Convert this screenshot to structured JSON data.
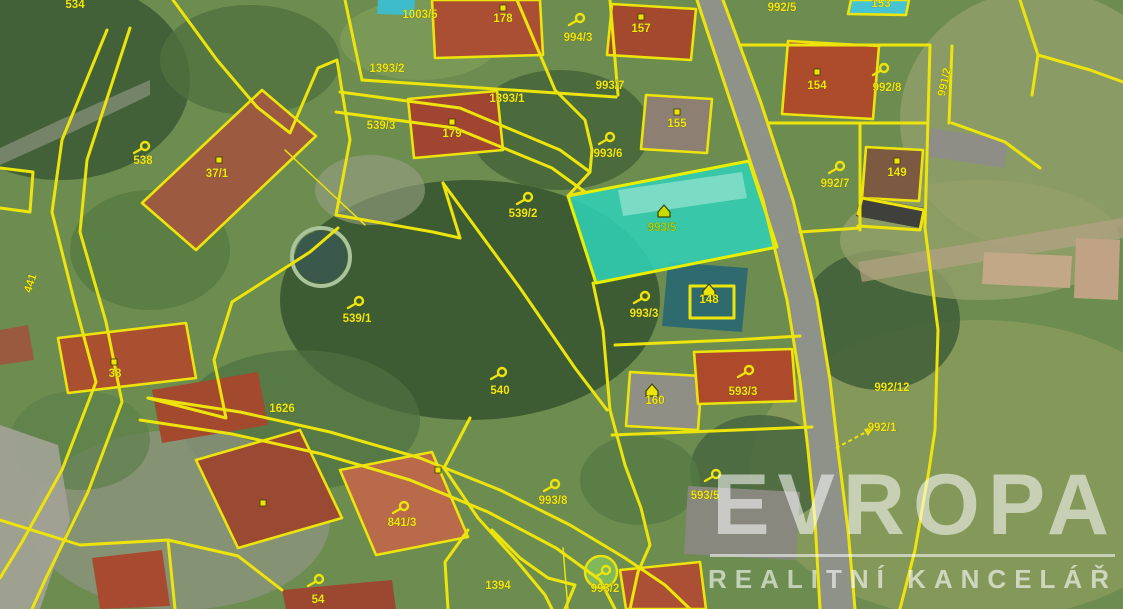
{
  "watermark": {
    "title": "EVROPA",
    "subtitle": "REALITNÍ KANCELÁŘ"
  },
  "map": {
    "colors": {
      "line": "#ede40b",
      "label": "#f0e714",
      "highlight_fill": "#2fd2b8",
      "highlight_label": "#9fd41c",
      "road_fill": "#8e9289"
    },
    "vegetation": [
      [
        60,
        80,
        130,
        100,
        "#3e5c36",
        0.9
      ],
      [
        250,
        60,
        90,
        55,
        "#50713f",
        0.8
      ],
      [
        470,
        300,
        190,
        120,
        "#3c5a32",
        0.95
      ],
      [
        560,
        130,
        90,
        60,
        "#47653a",
        0.85
      ],
      [
        150,
        250,
        80,
        60,
        "#567a42",
        0.8
      ],
      [
        300,
        420,
        120,
        70,
        "#4e7040",
        0.7
      ],
      [
        980,
        470,
        230,
        150,
        "#84985a",
        1
      ],
      [
        1040,
        120,
        140,
        130,
        "#8d9c68",
        0.9
      ],
      [
        880,
        320,
        80,
        70,
        "#43613a",
        0.9
      ],
      [
        760,
        470,
        70,
        55,
        "#48663e",
        0.85
      ],
      [
        180,
        520,
        150,
        90,
        "#8f9480",
        0.75
      ],
      [
        420,
        40,
        80,
        40,
        "#7d9b58",
        0.8
      ],
      [
        640,
        480,
        60,
        45,
        "#557a44",
        0.8
      ],
      [
        80,
        440,
        70,
        50,
        "#5d7f4a",
        0.7
      ],
      [
        980,
        240,
        140,
        60,
        "#93a06a",
        0.8
      ],
      [
        370,
        190,
        55,
        35,
        "#9aa086",
        0.6
      ]
    ],
    "surfaces": [
      {
        "name": "main-road",
        "pts": "697,0 730,100 763,200 787,300 800,380 808,450 815,520 820,609 855,609 848,530 838,450 830,380 817,300 793,200 760,100 723,0",
        "fill": "#8e9289",
        "op": 1
      },
      {
        "name": "left-street",
        "pts": "0,425 58,445 70,520 40,609 0,609",
        "fill": "#a3a396",
        "op": 0.9
      },
      {
        "name": "dirt-track",
        "pts": "858,262 1123,218 1123,238 862,282",
        "fill": "#b3a383",
        "op": 0.7
      },
      {
        "name": "path-top-left",
        "pts": "0,148 60,120 150,80 150,95 60,138 0,165",
        "fill": "#a8a89a",
        "op": 0.5
      }
    ],
    "buildings": [
      {
        "pts": "142,203 262,90 316,136 196,250",
        "fill": "#9c5a40",
        "outline": true
      },
      {
        "pts": "432,0 540,0 543,55 435,58",
        "fill": "#aa4f33",
        "outline": true
      },
      {
        "pts": "612,4 696,9 691,60 607,55",
        "fill": "#a34a2e",
        "outline": true
      },
      {
        "pts": "408,99 497,91 503,150 414,158",
        "fill": "#a04531",
        "outline": true
      },
      {
        "pts": "646,95 712,99 707,153 641,149",
        "fill": "#8d7f72",
        "outline": true
      },
      {
        "pts": "788,41 879,46 873,119 782,114",
        "fill": "#ad4c2a",
        "outline": true
      },
      {
        "pts": "866,147 923,150 919,201 862,198",
        "fill": "#7c5a42",
        "outline": true
      },
      {
        "pts": "851,0 909,0 906,15 848,14",
        "fill": "#45c4d4",
        "outline": true
      },
      {
        "pts": "668,262 748,268 742,332 662,326",
        "fill": "#2f6b6e",
        "outline": false
      },
      {
        "pts": "630,372 702,376 698,430 626,426",
        "fill": "#8f8f85",
        "outline": true
      },
      {
        "pts": "694,352 792,349 796,401 698,404",
        "fill": "#ad4a2c",
        "outline": true
      },
      {
        "pts": "58,338 186,323 196,378 68,393",
        "fill": "#aa5030",
        "outline": true
      },
      {
        "pts": "152,390 258,372 268,425 162,443",
        "fill": "#a34a2e",
        "outline": false
      },
      {
        "pts": "196,460 300,430 342,518 238,548",
        "fill": "#9a4a32",
        "outline": true
      },
      {
        "pts": "340,470 432,452 468,537 376,555",
        "fill": "#b96a4a",
        "outline": true
      },
      {
        "pts": "92,558 162,550 170,606 100,609",
        "fill": "#a84a30",
        "outline": false
      },
      {
        "pts": "282,590 392,580 396,609 286,609",
        "fill": "#9c4830",
        "outline": false
      },
      {
        "pts": "620,570 700,562 706,609 626,609",
        "fill": "#ab5034",
        "outline": true
      },
      {
        "pts": "860,196 924,208 920,228 856,216",
        "fill": "#3f3f3c",
        "outline": false
      },
      {
        "pts": "930,128 1008,140 1004,168 926,156",
        "fill": "#8e8e86",
        "outline": false
      },
      {
        "pts": "984,252 1072,256 1070,288 982,284",
        "fill": "#c3a887",
        "outline": false
      },
      {
        "pts": "1076,238 1120,240 1118,300 1074,298",
        "fill": "#bfa384",
        "outline": false
      },
      {
        "pts": "688,486 800,492 796,560 684,554",
        "fill": "#88887e",
        "outline": false
      },
      {
        "pts": "0,330 28,325 34,360 0,365",
        "fill": "#9a5a40",
        "outline": false
      },
      {
        "pts": "378,0 415,0 414,15 377,14",
        "fill": "#3fbccb",
        "outline": false
      }
    ],
    "pond": {
      "cx": 321,
      "cy": 257,
      "r": 26,
      "fill": "#3a584b",
      "ring": "#a9c39b"
    },
    "tree_circle": {
      "cx": 601,
      "cy": 572,
      "r": 16,
      "fill": "#7fb95a"
    },
    "boundaries": [
      {
        "pts": "107,30 62,140 52,212 74,300 96,382 62,470 22,542 0,578"
      },
      {
        "pts": "130,28 87,160 80,232 106,322 122,402 88,492 46,578 32,609"
      },
      {
        "pts": "173,0 217,60 257,107"
      },
      {
        "pts": "257,107 290,133 318,68 337,60"
      },
      {
        "pts": "337,60 350,140 336,215"
      },
      {
        "pts": "285,150 365,225",
        "w": 1.5
      },
      {
        "pts": "336,215 433,232 460,238"
      },
      {
        "pts": "460,238 443,183"
      },
      {
        "pts": "443,183 520,288 575,368 607,410"
      },
      {
        "pts": "593,283 603,330 610,410 625,465 641,508 650,545 638,572 630,609"
      },
      {
        "pts": "568,196 590,172 592,150 585,120 555,90 517,0"
      },
      {
        "pts": "340,92 460,108 560,150 590,172"
      },
      {
        "pts": "336,112 455,128 552,168 585,192 568,196"
      },
      {
        "pts": "362,80 616,97"
      },
      {
        "pts": "345,0 362,80"
      },
      {
        "pts": "610,0 618,95"
      },
      {
        "pts": "697,0 730,100 763,200 787,300 800,380 808,450 815,520 820,609"
      },
      {
        "pts": "723,0 760,100 793,200 817,300 830,380 838,450 848,530 855,609"
      },
      {
        "pts": "740,45 930,45"
      },
      {
        "pts": "930,45 925,228"
      },
      {
        "pts": "768,123 927,123"
      },
      {
        "pts": "952,46 949,123"
      },
      {
        "pts": "860,123 860,230"
      },
      {
        "pts": "800,232 860,228"
      },
      {
        "pts": "858,214 862,198 924,210 920,230 858,226"
      },
      {
        "pts": "925,228 938,330 935,430 929,470 915,550 900,609"
      },
      {
        "pts": "1020,0 1038,55 1032,95"
      },
      {
        "pts": "1038,55 1090,70 1123,82"
      },
      {
        "pts": "615,345 733,340 800,336"
      },
      {
        "pts": "612,435 812,427"
      },
      {
        "pts": "148,398 240,412 330,432 420,458 500,490 570,525 625,558 665,585 690,609"
      },
      {
        "pts": "140,420 232,434 322,454 410,480 488,512 556,548 600,580 615,609"
      },
      {
        "pts": "470,418 444,468 478,518 516,560 545,595 552,609"
      },
      {
        "pts": "0,520 80,545 168,540 238,556 282,590"
      },
      {
        "pts": "168,540 175,609"
      },
      {
        "pts": "0,168 33,172 30,212 0,208"
      },
      {
        "pts": "232,302 214,360 226,418 148,398"
      },
      {
        "pts": "338,228 310,252 232,302"
      },
      {
        "pts": "952,123 1005,142 1040,168"
      },
      {
        "pts": "468,530 445,562 448,609"
      },
      {
        "pts": "492,530 520,558 548,578 575,585 565,609"
      },
      {
        "pts": "563,548 568,609",
        "w": 1.5
      },
      {
        "pts": "690,286 734,286 734,318 690,318 690,286"
      }
    ],
    "highlight_parcel": {
      "label": "993/5",
      "pts": "568,196 749,161 777,247 596,283",
      "roof_strip": "618,190 742,172 747,198 623,216"
    },
    "labels": [
      {
        "t": "534",
        "x": 75,
        "y": 4
      },
      {
        "t": "538",
        "x": 143,
        "y": 160
      },
      {
        "t": "37/1",
        "x": 217,
        "y": 173
      },
      {
        "t": "441",
        "x": 30,
        "y": 283,
        "r": -72
      },
      {
        "t": "1003/5",
        "x": 420,
        "y": 14
      },
      {
        "t": "178",
        "x": 503,
        "y": 18
      },
      {
        "t": "994/3",
        "x": 578,
        "y": 37
      },
      {
        "t": "157",
        "x": 641,
        "y": 28
      },
      {
        "t": "1393/2",
        "x": 387,
        "y": 68
      },
      {
        "t": "1393/1",
        "x": 507,
        "y": 98
      },
      {
        "t": "993/7",
        "x": 610,
        "y": 85
      },
      {
        "t": "539/3",
        "x": 381,
        "y": 125
      },
      {
        "t": "179",
        "x": 452,
        "y": 133
      },
      {
        "t": "155",
        "x": 677,
        "y": 123
      },
      {
        "t": "993/6",
        "x": 608,
        "y": 153
      },
      {
        "t": "992/5",
        "x": 782,
        "y": 7
      },
      {
        "t": "153",
        "x": 881,
        "y": 3
      },
      {
        "t": "154",
        "x": 817,
        "y": 85
      },
      {
        "t": "992/8",
        "x": 887,
        "y": 87
      },
      {
        "t": "991/2",
        "x": 944,
        "y": 82,
        "r": -78
      },
      {
        "t": "149",
        "x": 897,
        "y": 172
      },
      {
        "t": "992/7",
        "x": 835,
        "y": 183
      },
      {
        "t": "539/2",
        "x": 523,
        "y": 213
      },
      {
        "t": "993/5",
        "x": 662,
        "y": 227,
        "c": "#9fd41c"
      },
      {
        "t": "539/1",
        "x": 357,
        "y": 318
      },
      {
        "t": "993/3",
        "x": 644,
        "y": 313
      },
      {
        "t": "148",
        "x": 709,
        "y": 299
      },
      {
        "t": "38",
        "x": 115,
        "y": 373
      },
      {
        "t": "540",
        "x": 500,
        "y": 390
      },
      {
        "t": "1626",
        "x": 282,
        "y": 408
      },
      {
        "t": "160",
        "x": 655,
        "y": 400
      },
      {
        "t": "593/3",
        "x": 743,
        "y": 391
      },
      {
        "t": "992/12",
        "x": 892,
        "y": 387
      },
      {
        "t": "992/1",
        "x": 882,
        "y": 427
      },
      {
        "t": "841/3",
        "x": 402,
        "y": 522
      },
      {
        "t": "993/8",
        "x": 553,
        "y": 500
      },
      {
        "t": "1394",
        "x": 498,
        "y": 585
      },
      {
        "t": "993/2",
        "x": 605,
        "y": 588
      },
      {
        "t": "593/5",
        "x": 705,
        "y": 495
      },
      {
        "t": "54",
        "x": 318,
        "y": 599
      }
    ],
    "grass_symbols": [
      [
        143,
        148
      ],
      [
        526,
        199
      ],
      [
        357,
        303
      ],
      [
        500,
        374
      ],
      [
        578,
        20
      ],
      [
        608,
        139
      ],
      [
        643,
        298
      ],
      [
        553,
        486
      ],
      [
        838,
        168
      ],
      [
        882,
        70
      ],
      [
        402,
        508
      ],
      [
        604,
        572
      ],
      [
        714,
        476
      ],
      [
        747,
        372
      ],
      [
        317,
        581
      ]
    ],
    "building_markers": [
      [
        503,
        8
      ],
      [
        641,
        17
      ],
      [
        452,
        122
      ],
      [
        677,
        112
      ],
      [
        817,
        72
      ],
      [
        897,
        161
      ],
      [
        219,
        160
      ],
      [
        114,
        362
      ],
      [
        263,
        503
      ],
      [
        438,
        470
      ]
    ],
    "house_icons": [
      {
        "x": 664,
        "y": 211,
        "c": "#c8dc00"
      },
      {
        "x": 709,
        "y": 290,
        "c": "#ede40b"
      },
      {
        "x": 652,
        "y": 390,
        "c": "#ede40b"
      }
    ],
    "arrow": {
      "x1": 836,
      "y1": 448,
      "x2": 870,
      "y2": 430
    }
  }
}
